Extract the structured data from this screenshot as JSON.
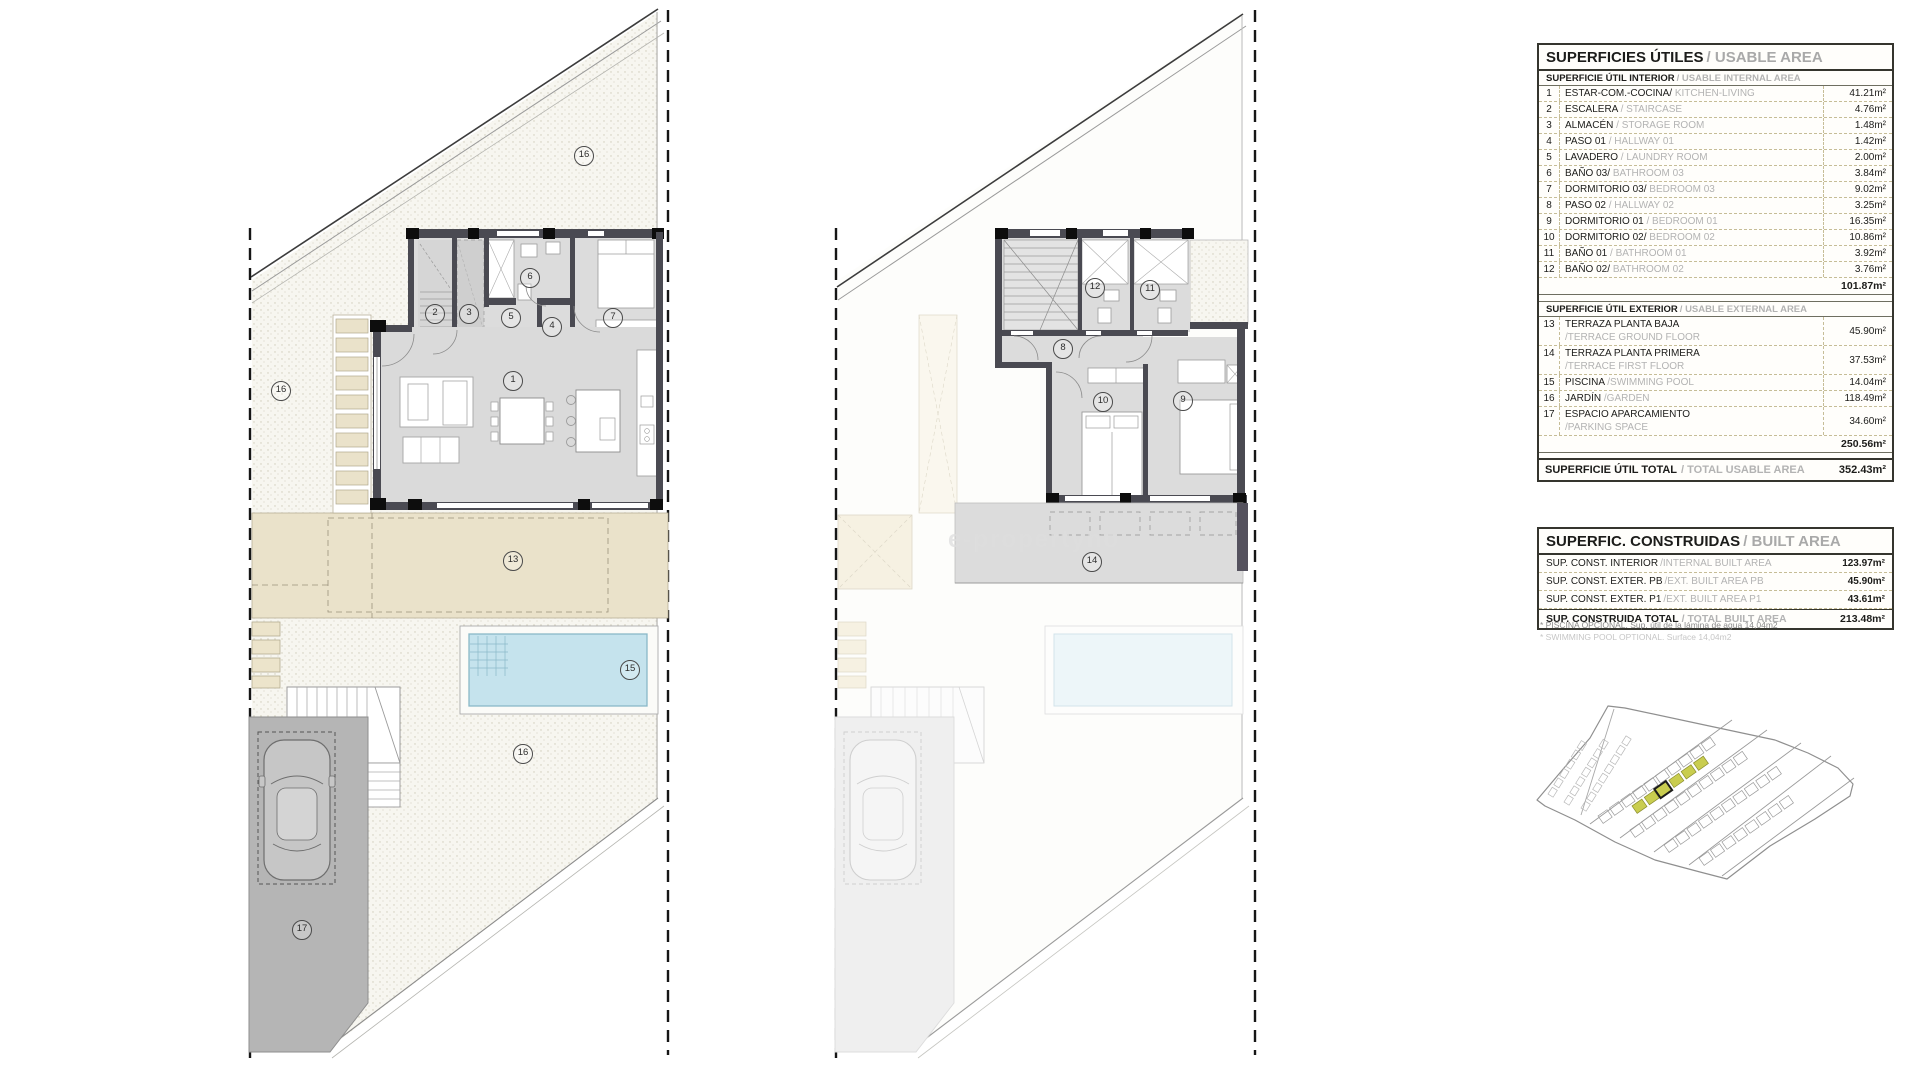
{
  "watermark": "e-propertyno",
  "plans": {
    "ground": {
      "name": "Ground floor plan",
      "labels": [
        "16",
        "16",
        "2",
        "3",
        "5",
        "6",
        "4",
        "7",
        "1",
        "13",
        "15",
        "16",
        "17"
      ]
    },
    "first": {
      "name": "First floor plan",
      "labels": [
        "12",
        "11",
        "8",
        "10",
        "9",
        "14"
      ]
    }
  },
  "tables": {
    "usable": {
      "title_es": "SUPERFICIES ÚTILES",
      "title_en": "/ USABLE AREA",
      "interior_header_es": "SUPERFICIE ÚTIL INTERIOR",
      "interior_header_en": "/ USABLE INTERNAL AREA",
      "interior_rows": [
        {
          "num": "1",
          "es": "ESTAR-COM.-COCINA/",
          "en": "KITCHEN-LIVING",
          "value": "41.21m²"
        },
        {
          "num": "2",
          "es": "ESCALERA",
          "en": "/ STAIRCASE",
          "value": "4.76m²"
        },
        {
          "num": "3",
          "es": "ALMACÉN",
          "en": "/ STORAGE ROOM",
          "value": "1.48m²"
        },
        {
          "num": "4",
          "es": "PASO 01",
          "en": "/ HALLWAY 01",
          "value": "1.42m²"
        },
        {
          "num": "5",
          "es": "LAVADERO",
          "en": "/ LAUNDRY ROOM",
          "value": "2.00m²"
        },
        {
          "num": "6",
          "es": "BAÑO 03/",
          "en": "BATHROOM 03",
          "value": "3.84m²"
        },
        {
          "num": "7",
          "es": "DORMITORIO 03/",
          "en": "BEDROOM 03",
          "value": "9.02m²"
        },
        {
          "num": "8",
          "es": "PASO 02",
          "en": "/ HALLWAY 02",
          "value": "3.25m²"
        },
        {
          "num": "9",
          "es": "DORMITORIO 01",
          "en": "/ BEDROOM 01",
          "value": "16.35m²"
        },
        {
          "num": "10",
          "es": "DORMITORIO 02/",
          "en": "BEDROOM 02",
          "value": "10.86m²"
        },
        {
          "num": "11",
          "es": "BAÑO 01",
          "en": "/ BATHROOM 01",
          "value": "3.92m²"
        },
        {
          "num": "12",
          "es": "BAÑO 02/",
          "en": "BATHROOM 02",
          "value": "3.76m²"
        }
      ],
      "interior_total": "101.87m²",
      "exterior_header_es": "SUPERFICIE ÚTIL EXTERIOR",
      "exterior_header_en": "/ USABLE EXTERNAL AREA",
      "exterior_rows": [
        {
          "num": "13",
          "es": "TERRAZA PLANTA BAJA",
          "en": "\n/TERRACE GROUND FLOOR",
          "value": "45.90m²"
        },
        {
          "num": "14",
          "es": "TERRAZA PLANTA PRIMERA",
          "en": "\n/TERRACE FIRST FLOOR",
          "value": "37.53m²"
        },
        {
          "num": "15",
          "es": "PISCINA",
          "en": "/SWIMMING POOL",
          "value": "14.04m²"
        },
        {
          "num": "16",
          "es": "JARDÍN",
          "en": "/GARDEN",
          "value": "118.49m²"
        },
        {
          "num": "17",
          "es": "ESPACIO APARCAMIENTO",
          "en": "\n/PARKING SPACE",
          "value": "34.60m²"
        }
      ],
      "exterior_total": "250.56m²",
      "total_label_es": "SUPERFICIE ÚTIL TOTAL",
      "total_label_en": "/ TOTAL USABLE AREA",
      "total_value": "352.43m²"
    },
    "built": {
      "title_es": "SUPERFIC. CONSTRUIDAS",
      "title_en": "/ BUILT AREA",
      "rows": [
        {
          "es": "SUP. CONST. INTERIOR",
          "en": "/INTERNAL BUILT AREA",
          "value": "123.97m²"
        },
        {
          "es": "SUP. CONST. EXTER. PB",
          "en": "/EXT. BUILT AREA PB",
          "value": "45.90m²"
        },
        {
          "es": "SUP. CONST. EXTER. P1",
          "en": "/EXT. BUILT AREA P1",
          "value": "43.61m²"
        }
      ],
      "total_label_es": "SUP. CONSTRUIDA TOTAL",
      "total_label_en": "/ TOTAL BUILT AREA",
      "total_value": "213.48m²"
    }
  },
  "footnotes": [
    "* PISCINA OPCIONAL. Sup. útil de la lámina de agua 14,04m2",
    "* SWIMMING POOL OPTIONAL. Surface 14,04m2"
  ],
  "site_plan": {
    "highlight_color": "#c9cd4f",
    "selected_outline": "#1d1d1b"
  }
}
